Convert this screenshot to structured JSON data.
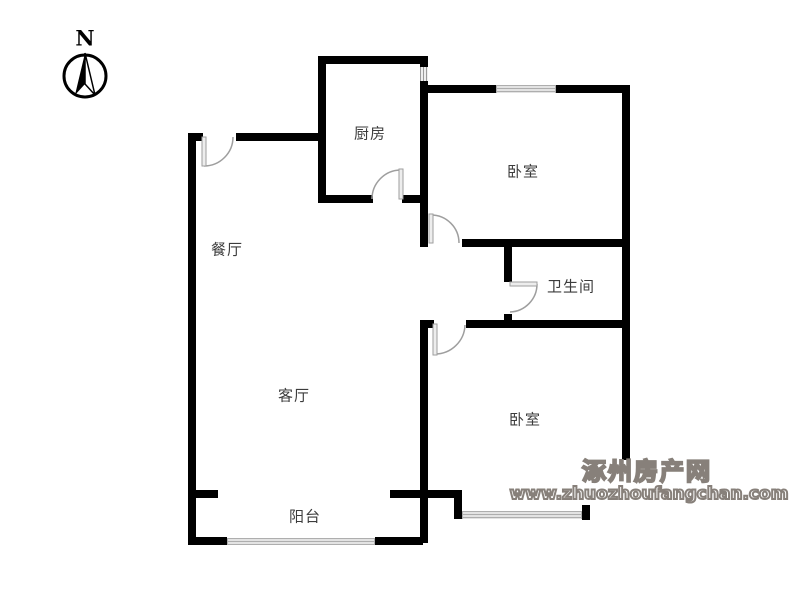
{
  "title": "apartment-floor-plan",
  "compass": {
    "label": "N"
  },
  "rooms": [
    {
      "id": "kitchen",
      "label": "厨房"
    },
    {
      "id": "bedroom-top",
      "label": "卧室"
    },
    {
      "id": "dining",
      "label": "餐厅"
    },
    {
      "id": "bathroom",
      "label": "卫生间"
    },
    {
      "id": "living",
      "label": "客厅"
    },
    {
      "id": "bedroom-bottom",
      "label": "卧室"
    },
    {
      "id": "balcony",
      "label": "阳台"
    }
  ],
  "watermark": {
    "site_name": "涿州房产网",
    "site_url": "www.zhuozhoufangchan.com"
  },
  "icons": [
    "north-arrow-icon",
    "entry-door-arc-icon",
    "kitchen-door-arc-icon",
    "bedroom-top-door-arc-icon",
    "bathroom-door-arc-icon",
    "bedroom-bottom-door-arc-icon",
    "window-icon",
    "flue-vent-icon"
  ],
  "colors": {
    "wall": "#000000",
    "door_line": "#9e9e9e",
    "window_line": "#aeaeae",
    "label_text": "#3c3c3c",
    "watermark": "#87807a",
    "background": "#ffffff"
  }
}
